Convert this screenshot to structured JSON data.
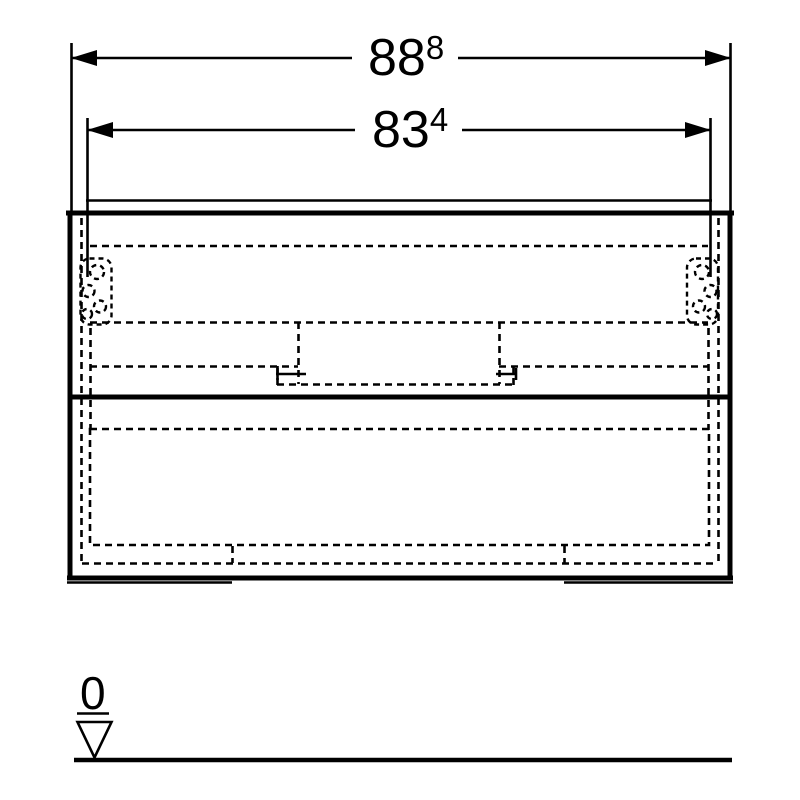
{
  "page": {
    "background": "#ffffff",
    "line_color": "#000000"
  },
  "dimensions": {
    "overall_width": {
      "value": "88",
      "superscript": "8"
    },
    "cutout_width": {
      "value": "83",
      "superscript": "4"
    }
  },
  "datum": {
    "level_label": "0"
  }
}
